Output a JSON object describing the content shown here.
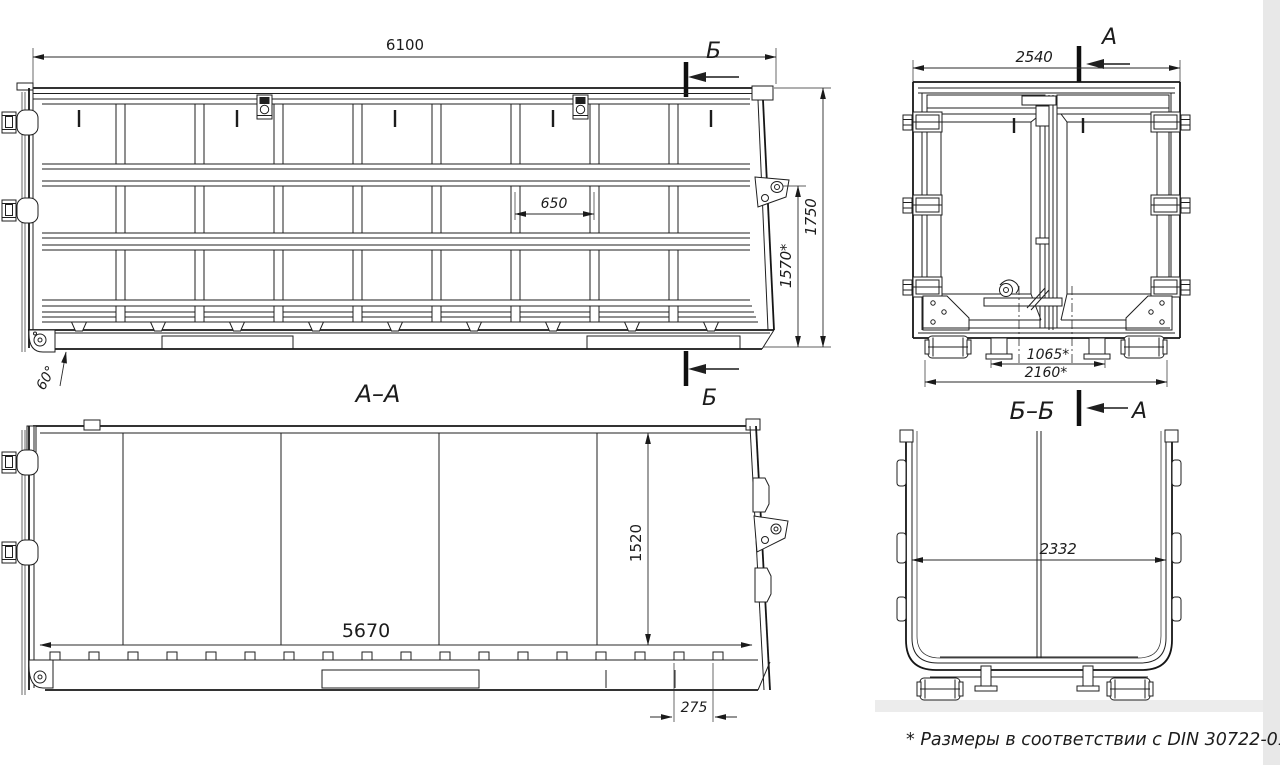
{
  "page": {
    "background": "#ffffff",
    "line_color": "#1f1f1f",
    "shade_color": "#e9e9e9",
    "note": "* Размеры в соответствии с DIN 30722-01"
  },
  "side_view": {
    "cut_label": "Б",
    "dims": {
      "length": "6100",
      "height": "1750",
      "inner_height": "1570*",
      "panel_pitch": "650",
      "angle": "60°"
    }
  },
  "rear_view": {
    "cut_label": "А",
    "dims": {
      "width": "2540",
      "feet_span": "1065*",
      "roller_span": "2160*"
    }
  },
  "section_aa": {
    "title": "А–А",
    "dims": {
      "inner_length": "5670",
      "inner_height": "1520",
      "tab_pitch": "275"
    }
  },
  "section_bb": {
    "title": "Б–Б",
    "dims": {
      "inner_width": "2332"
    }
  }
}
